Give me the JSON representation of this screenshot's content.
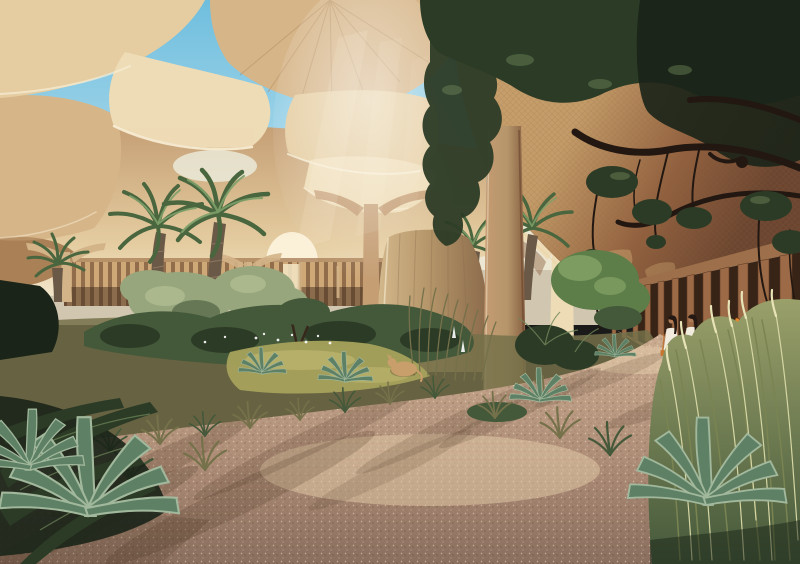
{
  "image": {
    "type": "architectural-rendering",
    "description": "Shaded desert oasis garden beneath sculptural woven canopy parasols: date palms, an old acacia tree, agaves and desert grasses around sandy pink gravel paths, a timber-slat colonnade walkway at right, and two women in white dresses strolling; an orange butterfly rests on tall grass and a sand-colored animal naps in the planting.",
    "people": [
      {
        "label": "woman in white dress (left)",
        "carrying": "orange handbag"
      },
      {
        "label": "woman in white dress (right)"
      }
    ],
    "wildlife": [
      {
        "label": "orange butterfly on grass stalk"
      },
      {
        "label": "sand-colored animal resting in undergrowth"
      }
    ],
    "flora": [
      "date palms",
      "acacia tree",
      "olive shrubs",
      "agaves",
      "reed and plume grasses",
      "white flowering plants"
    ],
    "architecture": [
      "woven rattan canopy parasols on trumpet columns",
      "sweeping woven roof",
      "timber slat colonnade",
      "earthen columns",
      "stone monolith"
    ]
  },
  "palette": {
    "skytop": "#6fbede",
    "skybot": "#c9e7f1",
    "haze": "#f2e6cc",
    "canopycream": "#eedcb6",
    "canopylight": "#e5cda1",
    "canopytan": "#d6b588",
    "canopygold": "#c9a26e",
    "canopyshadow": "#aa8157",
    "canopyrim": "#f8eed6",
    "canopyunder": "#c59e74",
    "weave": "#8a6440",
    "roofgold": "#c39b68",
    "roofbrown": "#92613f",
    "roofdark": "#6b4530",
    "soffitrim": "#eacfa0",
    "slat": "#9c6a46",
    "slatdark": "#5f3c26",
    "opening": "#372417",
    "wall": "#cfa878",
    "floorwarm": "#b58a68",
    "monolight": "#d3b88c",
    "monomid": "#b5966a",
    "monodark": "#8a6a4a",
    "columnlit": "#c69b73",
    "columnshadow": "#835a3e",
    "stem": "#d3b488",
    "trunk": "#6b5947",
    "trunklit": "#97826a",
    "branch": "#221711",
    "foliagedark": "#2c3b26",
    "foliagedeep": "#1a2418",
    "foliagemid": "#44583a",
    "foliagelight": "#70885a",
    "olive": "#97a67c",
    "treegreen": "#5d7d49",
    "treegreenlight": "#86a468",
    "palmdark": "#49663f",
    "palmlight": "#7fa069",
    "agave": "#5e8166",
    "agavelight": "#a2b89c",
    "grassolive": "#75714a",
    "grasstall": "#9aa06a",
    "plume": "#d6d6a4",
    "lawn": "#a6a25c",
    "pathlit": "#cbac90",
    "pathmid": "#ae8d77",
    "pathshadow": "#8a6e5e",
    "dapple": "#46321f",
    "dress": "#f2ecdf",
    "dressshadow": "#d8cbb6",
    "skin": "#b07b55",
    "hair": "#241812",
    "bag": "#c8752d",
    "butterfly": "#e2882e",
    "animal": "#c89e6b",
    "ray": "#fff3da",
    "white": "#ffffff"
  }
}
